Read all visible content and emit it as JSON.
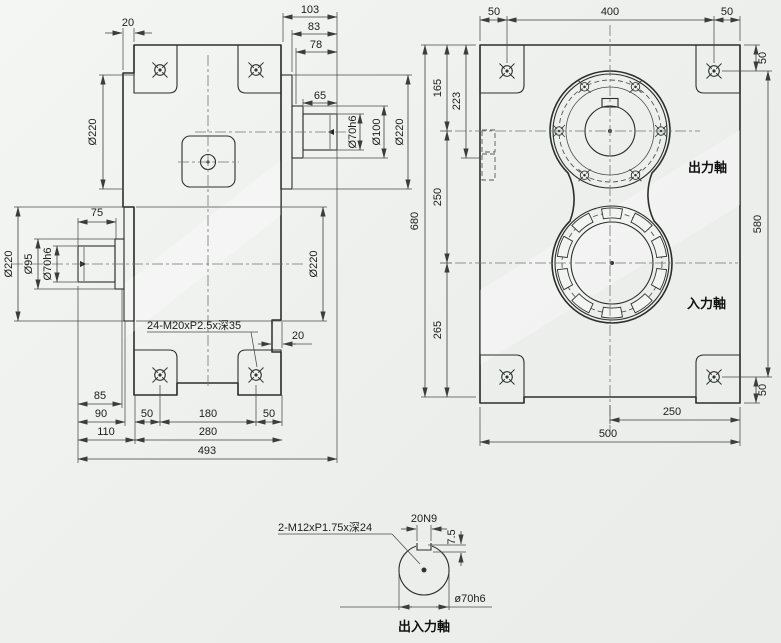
{
  "front_view": {
    "dim_20_top": "20",
    "dim_103": "103",
    "dim_83": "83",
    "dim_78": "78",
    "dim_65": "65",
    "dim_d70h6_top": "Ø70h6",
    "dim_d100": "Ø100",
    "dim_d220_top_right": "Ø220",
    "dim_d220_top_left": "Ø220",
    "dim_75": "75",
    "dim_d220_left": "Ø220",
    "dim_d95": "Ø95",
    "dim_d70h6_left": "Ø70h6",
    "dim_d220_right": "Ø220",
    "thread_note": "24-M20xP2.5x深35",
    "dim_20_bottom": "20",
    "dim_85": "85",
    "dim_90": "90",
    "dim_110": "110",
    "dim_50_left": "50",
    "dim_180": "180",
    "dim_50_right": "50",
    "dim_280": "280",
    "dim_493": "493"
  },
  "side_view": {
    "dim_50_tl": "50",
    "dim_400": "400",
    "dim_50_tr": "50",
    "dim_50_right_top": "50",
    "dim_580": "580",
    "dim_50_right_bottom": "50",
    "dim_165": "165",
    "dim_223": "223",
    "dim_680": "680",
    "dim_250_left": "250",
    "dim_265": "265",
    "label_output_shaft": "出力軸",
    "label_input_shaft": "入力軸",
    "dim_250_bottom": "250",
    "dim_500": "500"
  },
  "detail_view": {
    "thread_note": "2-M12xP1.75x深24",
    "dim_keyway": "20N9",
    "dim_depth": "7.5",
    "dim_dia": "ø70h6",
    "caption": "出入力軸"
  },
  "colors": {
    "body_green": "#c6d5c8",
    "pad_green": "#a9bfae",
    "line_dark": "#2b302b",
    "background": "#eef0ee"
  }
}
